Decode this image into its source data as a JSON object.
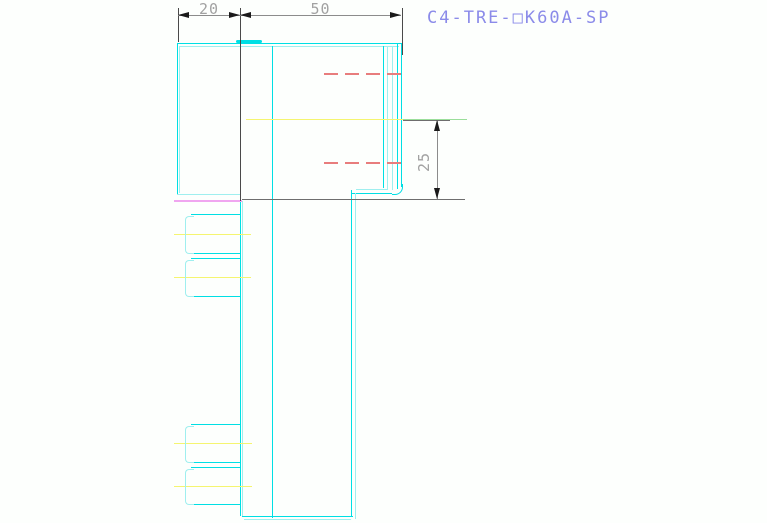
{
  "title": {
    "text": "C4-TRE-□K60A-SP"
  },
  "dimensions": {
    "width_left": {
      "label": "20"
    },
    "width_right": {
      "label": "50"
    },
    "height_right": {
      "label": "25"
    }
  },
  "colors": {
    "cyan": "#00DFE4",
    "cyanLight": "#9FEFEF",
    "yellow": "#F5F570",
    "green": "#9ADE9A",
    "red": "#E87D7D",
    "magenta": "#F0A6F0",
    "ext": "#4A4A4A",
    "dimline": "#8C8C8C",
    "arrow": "#1A1A1A",
    "gray": "#6E6E6E",
    "dimtext": "#A2A2A2",
    "title": "#8B8BE9"
  },
  "drawing": {
    "lines": [
      {
        "name": "part-top-outer-edge",
        "x": 177,
        "y": 43,
        "w": 224,
        "h": 1,
        "c": "cyan"
      },
      {
        "name": "part-top-inner-edge",
        "x": 179,
        "y": 46,
        "w": 220,
        "h": 1,
        "c": "cyanLight"
      },
      {
        "name": "part-top-tab",
        "x": 236,
        "y": 40,
        "w": 26,
        "h": 3,
        "c": "cyan",
        "r": "2px"
      },
      {
        "name": "part-left-outer-edge",
        "x": 177,
        "y": 43,
        "w": 1,
        "h": 151,
        "c": "cyan"
      },
      {
        "name": "part-left-inner-edge",
        "x": 179,
        "y": 46,
        "w": 1,
        "h": 147,
        "c": "cyanLight"
      },
      {
        "name": "part-bottom-left-edge",
        "x": 177,
        "y": 194,
        "w": 63,
        "h": 1,
        "c": "cyanLight"
      },
      {
        "name": "part-mid-vertical-edge",
        "x": 272,
        "y": 46,
        "w": 1,
        "h": 472,
        "c": "cyan"
      },
      {
        "name": "right-wall-line-1",
        "x": 383,
        "y": 46,
        "w": 1,
        "h": 142,
        "c": "cyan"
      },
      {
        "name": "right-wall-line-2",
        "x": 387,
        "y": 46,
        "w": 1,
        "h": 144,
        "c": "cyanLight"
      },
      {
        "name": "right-wall-line-3",
        "x": 392,
        "y": 46,
        "w": 1,
        "h": 144,
        "c": "cyanLight"
      },
      {
        "name": "right-wall-line-4",
        "x": 397,
        "y": 43,
        "w": 1,
        "h": 146,
        "c": "cyan"
      },
      {
        "name": "right-wall-line-5",
        "x": 401,
        "y": 43,
        "w": 1,
        "h": 144,
        "c": "cyan"
      },
      {
        "name": "step-edge-light",
        "x": 356,
        "y": 189,
        "w": 32,
        "h": 1,
        "c": "cyanLight"
      },
      {
        "name": "step-edge-bright",
        "x": 352,
        "y": 193,
        "w": 40,
        "h": 1,
        "c": "cyan"
      },
      {
        "name": "column-left-edge",
        "x": 240,
        "y": 201,
        "w": 1,
        "h": 315,
        "c": "cyan"
      },
      {
        "name": "column-left-edge-2",
        "x": 242,
        "y": 201,
        "w": 1,
        "h": 315,
        "c": "cyanLight"
      },
      {
        "name": "column-right-edge",
        "x": 351,
        "y": 190,
        "w": 1,
        "h": 326,
        "c": "cyan"
      },
      {
        "name": "column-right-edge-2",
        "x": 355,
        "y": 193,
        "w": 1,
        "h": 326,
        "c": "cyanLight"
      },
      {
        "name": "column-bottom-edge",
        "x": 242,
        "y": 516,
        "w": 111,
        "h": 1,
        "c": "cyan"
      },
      {
        "name": "column-bottom-edge-2",
        "x": 244,
        "y": 519,
        "w": 107,
        "h": 1,
        "c": "cyanLight"
      },
      {
        "name": "slot-a-top",
        "x": 191,
        "y": 214,
        "w": 49,
        "h": 1,
        "c": "cyan"
      },
      {
        "name": "slot-a-bottom",
        "x": 191,
        "y": 253,
        "w": 49,
        "h": 1,
        "c": "cyan"
      },
      {
        "name": "slot-b-top",
        "x": 191,
        "y": 258,
        "w": 49,
        "h": 1,
        "c": "cyan"
      },
      {
        "name": "slot-b-bottom",
        "x": 191,
        "y": 296,
        "w": 49,
        "h": 1,
        "c": "cyan"
      },
      {
        "name": "slot-c-top",
        "x": 191,
        "y": 424,
        "w": 49,
        "h": 1,
        "c": "cyan"
      },
      {
        "name": "slot-c-bottom",
        "x": 191,
        "y": 462,
        "w": 49,
        "h": 1,
        "c": "cyan"
      },
      {
        "name": "slot-d-top",
        "x": 191,
        "y": 467,
        "w": 49,
        "h": 1,
        "c": "cyan"
      },
      {
        "name": "slot-d-bottom",
        "x": 191,
        "y": 504,
        "w": 49,
        "h": 1,
        "c": "cyan"
      },
      {
        "name": "centerline-main-yellow",
        "x": 246,
        "y": 119,
        "w": 157,
        "h": 1,
        "c": "yellow"
      },
      {
        "name": "centerline-main-green",
        "x": 403,
        "y": 119,
        "w": 64,
        "h": 1,
        "c": "green"
      },
      {
        "name": "centerline-slot-a",
        "x": 174,
        "y": 234,
        "w": 77,
        "h": 1,
        "c": "yellow"
      },
      {
        "name": "centerline-slot-b",
        "x": 174,
        "y": 277,
        "w": 77,
        "h": 1,
        "c": "yellow"
      },
      {
        "name": "centerline-slot-c",
        "x": 174,
        "y": 443,
        "w": 78,
        "h": 1,
        "c": "yellow"
      },
      {
        "name": "centerline-slot-d",
        "x": 174,
        "y": 486,
        "w": 78,
        "h": 1,
        "c": "yellow"
      },
      {
        "name": "magenta-edge-line",
        "x": 174,
        "y": 200,
        "w": 68,
        "h": 2,
        "c": "magenta"
      },
      {
        "name": "gray-datum-line",
        "x": 242,
        "y": 199,
        "w": 223,
        "h": 1,
        "c": "gray"
      },
      {
        "name": "dim20-extension-left",
        "x": 178,
        "y": 8,
        "w": 1,
        "h": 34,
        "c": "ext"
      },
      {
        "name": "dim-extension-middle",
        "x": 240,
        "y": 8,
        "w": 1,
        "h": 193,
        "c": "ext"
      },
      {
        "name": "dim50-extension-right",
        "x": 402,
        "y": 8,
        "w": 1,
        "h": 47,
        "c": "ext"
      },
      {
        "name": "dim-top-line",
        "x": 178,
        "y": 15,
        "w": 223,
        "h": 1,
        "c": "dimline"
      },
      {
        "name": "dim25-line",
        "x": 437,
        "y": 120,
        "w": 1,
        "h": 79,
        "c": "dimline"
      },
      {
        "name": "dim25-extension-top",
        "x": 403,
        "y": 120,
        "w": 47,
        "h": 1,
        "c": "gray"
      }
    ],
    "outlines": [
      {
        "name": "slot-a-cap",
        "x": 185,
        "y": 216,
        "w": 8,
        "h": 36,
        "c": "cyanLight",
        "sides": "ltb",
        "r": "4px 0 0 4px"
      },
      {
        "name": "slot-b-cap",
        "x": 185,
        "y": 260,
        "w": 8,
        "h": 35,
        "c": "cyanLight",
        "sides": "ltb",
        "r": "4px 0 0 4px"
      },
      {
        "name": "slot-c-cap",
        "x": 185,
        "y": 426,
        "w": 8,
        "h": 35,
        "c": "cyanLight",
        "sides": "ltb",
        "r": "4px 0 0 4px"
      },
      {
        "name": "slot-d-cap",
        "x": 185,
        "y": 469,
        "w": 8,
        "h": 34,
        "c": "cyanLight",
        "sides": "ltb",
        "r": "4px 0 0 4px"
      },
      {
        "name": "wall-bottom-corner",
        "x": 392,
        "y": 184,
        "w": 10,
        "h": 10,
        "c": "cyan",
        "sides": "rb",
        "r": "0 0 8px 0"
      }
    ],
    "dashes": [
      {
        "name": "hidden-line-upper",
        "x": 324,
        "y": 73,
        "w": 80,
        "c": "red"
      },
      {
        "name": "hidden-line-lower",
        "x": 324,
        "y": 162,
        "w": 80,
        "c": "red"
      }
    ],
    "arrows": [
      {
        "name": "dim20-arrow-left",
        "x": 178,
        "y": 15,
        "dir": "left",
        "c": "arrow"
      },
      {
        "name": "dim20-arrow-right",
        "x": 240,
        "y": 15,
        "dir": "right",
        "c": "arrow"
      },
      {
        "name": "dim50-arrow-left",
        "x": 240,
        "y": 15,
        "dir": "left",
        "c": "arrow"
      },
      {
        "name": "dim50-arrow-right",
        "x": 401,
        "y": 15,
        "dir": "right",
        "c": "arrow"
      },
      {
        "name": "dim25-arrow-up",
        "x": 437,
        "y": 120,
        "dir": "up",
        "c": "arrow"
      },
      {
        "name": "dim25-arrow-down",
        "x": 437,
        "y": 199,
        "dir": "down",
        "c": "arrow"
      }
    ]
  }
}
